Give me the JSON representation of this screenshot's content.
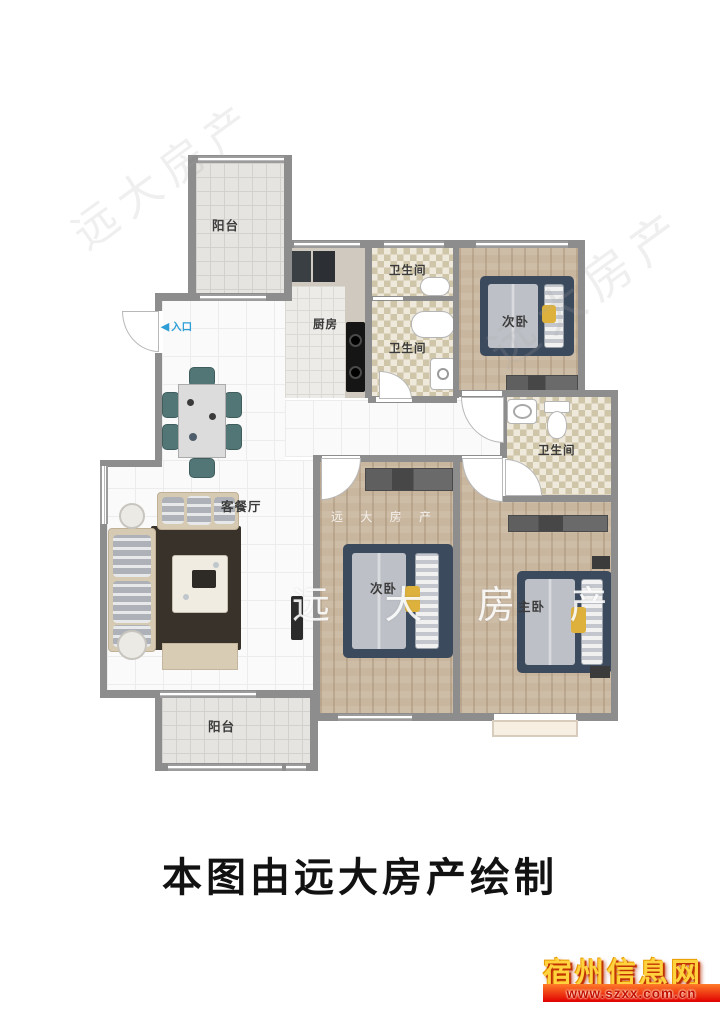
{
  "caption": "本图由远大房产绘制",
  "entry": {
    "arrow": "◀",
    "label": "入口"
  },
  "rooms": {
    "balcony_top": "阳台",
    "kitchen": "厨房",
    "bath_top": "卫生间",
    "bath_mid": "卫生间",
    "bath_right": "卫生间",
    "bedroom_top": "次卧",
    "living": "客餐厅",
    "bedroom_mid": "次卧",
    "master": "主卧",
    "balcony_bottom": "阳台"
  },
  "watermarks": {
    "large": "远 大 房 产",
    "small": "远 大 房 产",
    "ghost": "远大房产"
  },
  "footer_logo": {
    "site_name": "宿州信息网",
    "site_url": "www.szxx.com.cn"
  },
  "colors": {
    "wall": "#8d8d8d",
    "wood_floor": "#c9b69e",
    "bed_navy": "#3c4a5d",
    "accent_yellow": "#ddb13c",
    "entry_blue": "#2e9fd6",
    "logo_yellow": "#ffd23e",
    "logo_red": "#d40000"
  }
}
